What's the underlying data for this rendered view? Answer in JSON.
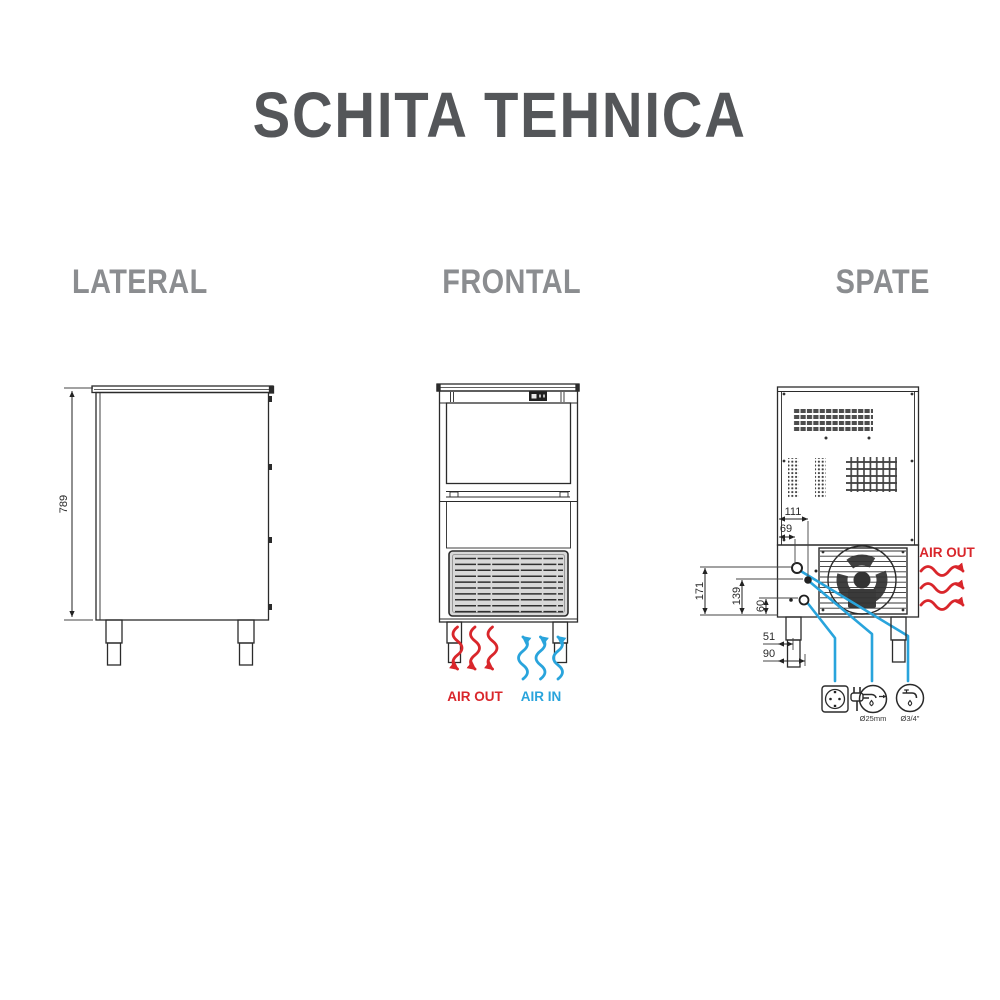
{
  "title": "SCHITA TEHNICA",
  "views": {
    "lateral": {
      "label": "LATERAL",
      "dim_height": "789"
    },
    "frontal": {
      "label": "FRONTAL",
      "air_out": "AIR OUT",
      "air_in": "AIR IN"
    },
    "spate": {
      "label": "SPATE",
      "air_out": "AIR OUT",
      "dims": {
        "d111": "111",
        "d69": "69",
        "d171": "171",
        "d139": "139",
        "d60": "60",
        "d51": "51",
        "d90": "90"
      },
      "connections": [
        {
          "name": "power-socket",
          "label": ""
        },
        {
          "name": "drain",
          "label": "Ø25mm"
        },
        {
          "name": "water-inlet",
          "label": "Ø3/4\""
        }
      ]
    }
  },
  "colors": {
    "air_out_red": "#d9262b",
    "air_in_blue": "#29a4dc",
    "line": "#2b2b2b",
    "title_gray": "#545659",
    "label_gray": "#8b8d90",
    "grille_fill": "#d8d8d8"
  }
}
